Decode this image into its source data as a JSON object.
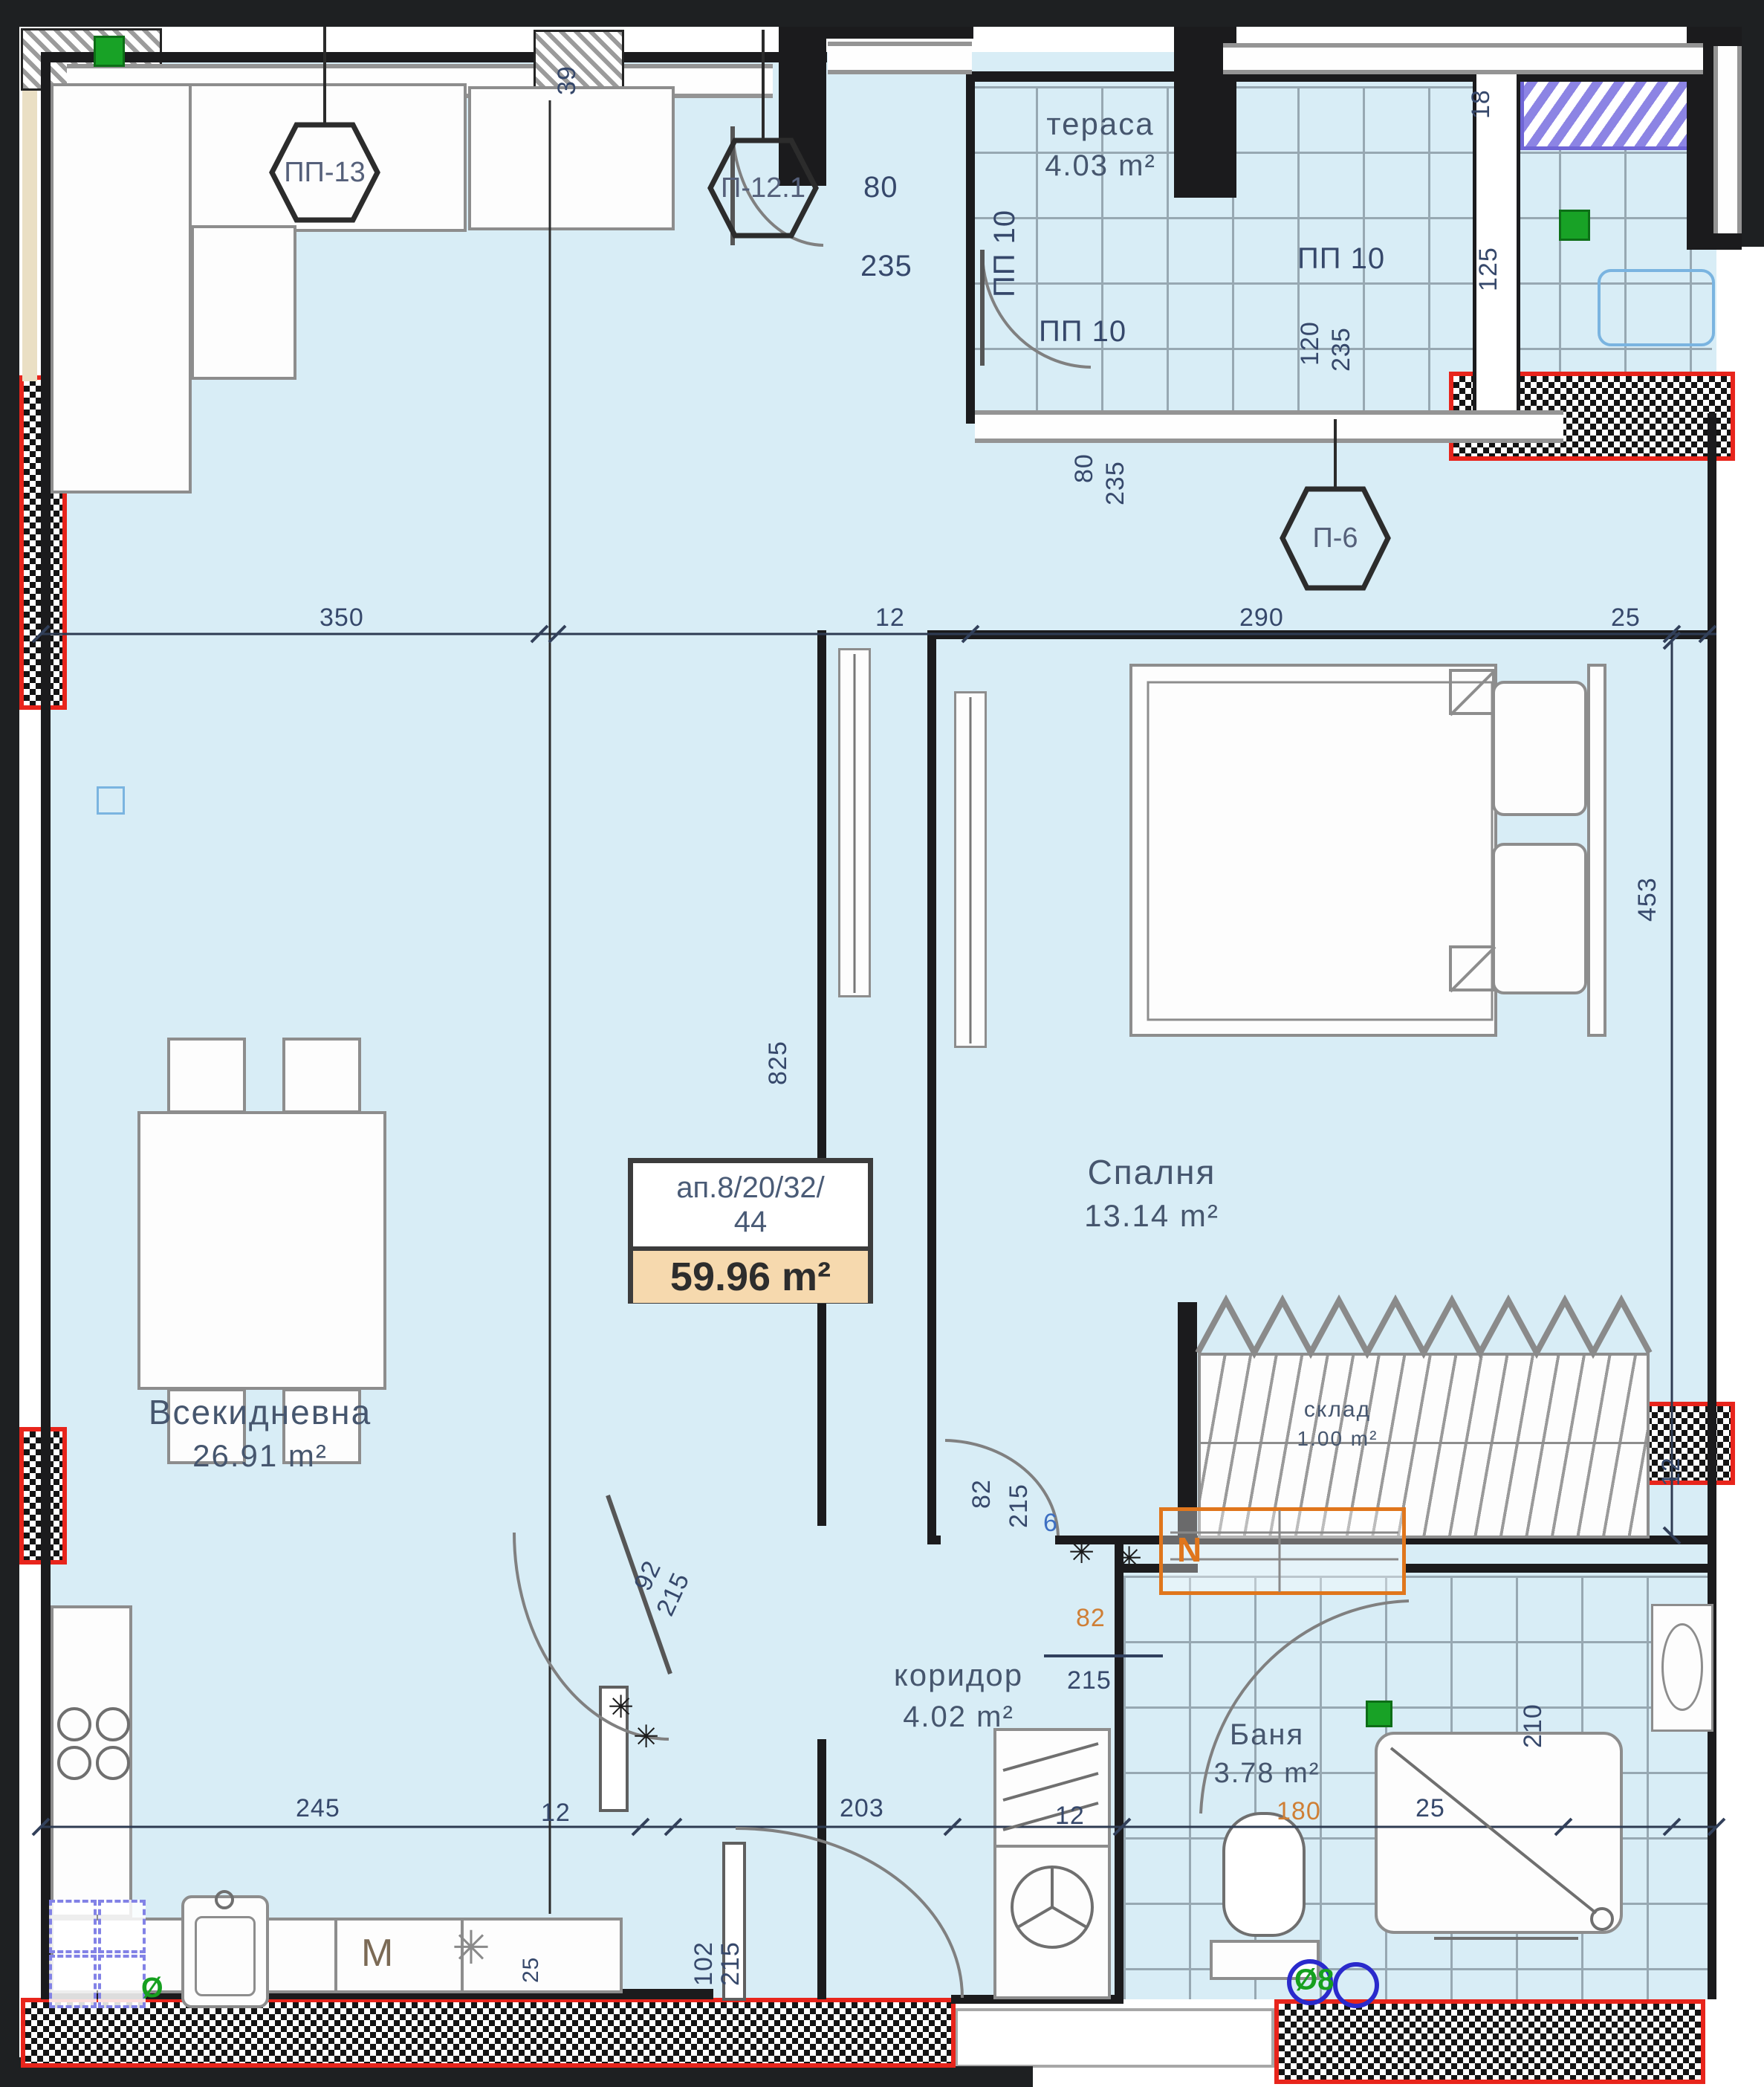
{
  "meta": {
    "type": "apartment-floor-plan"
  },
  "rooms": {
    "living": {
      "name": "Всекидневна",
      "area": "26.91 m²"
    },
    "bedroom": {
      "name": "Спалня",
      "area": "13.14 m²"
    },
    "terrace": {
      "name": "тераса",
      "area": "4.03 m²"
    },
    "corridor": {
      "name": "коридор",
      "area": "4.02 m²"
    },
    "bath": {
      "name": "Баня",
      "area": "3.78 m²"
    },
    "storage": {
      "name": "склад",
      "area": "1.00 m²"
    }
  },
  "unit": {
    "id_line": "ап.8/20/32/",
    "id_line2": "44",
    "area": "59.96 m²"
  },
  "tags": {
    "pp13": "ПП-13",
    "p121": "П-12.1",
    "p6": "П-6",
    "pp10": "ПП 10"
  },
  "dims": {
    "d350": "350",
    "d290": "290",
    "d245": "245",
    "d203": "203",
    "d180": "180",
    "d215": "215",
    "d235": "235",
    "d210": "210",
    "d120": "120",
    "d125": "125",
    "d102": "102",
    "d825": "825",
    "d453": "453",
    "d92": "92",
    "d82": "82",
    "d80": "80",
    "d39": "39",
    "d25": "25",
    "d18": "18",
    "d12": "12",
    "d6": "6"
  },
  "symbols": {
    "washer": "M",
    "snowflake": "✳",
    "post": "✳",
    "diameter": "Ø8",
    "phi": "Ø",
    "n": "N"
  },
  "colors": {
    "floor": "#d8edf6",
    "wall": "#1b1b1d",
    "fire_wall_red": "#e8251c",
    "accent_orange": "#e0761c",
    "accent_green": "#18a226",
    "accent_purple": "#6f66d6",
    "dim_text": "#36486b",
    "unit_area_bg": "#f6d9ae"
  }
}
